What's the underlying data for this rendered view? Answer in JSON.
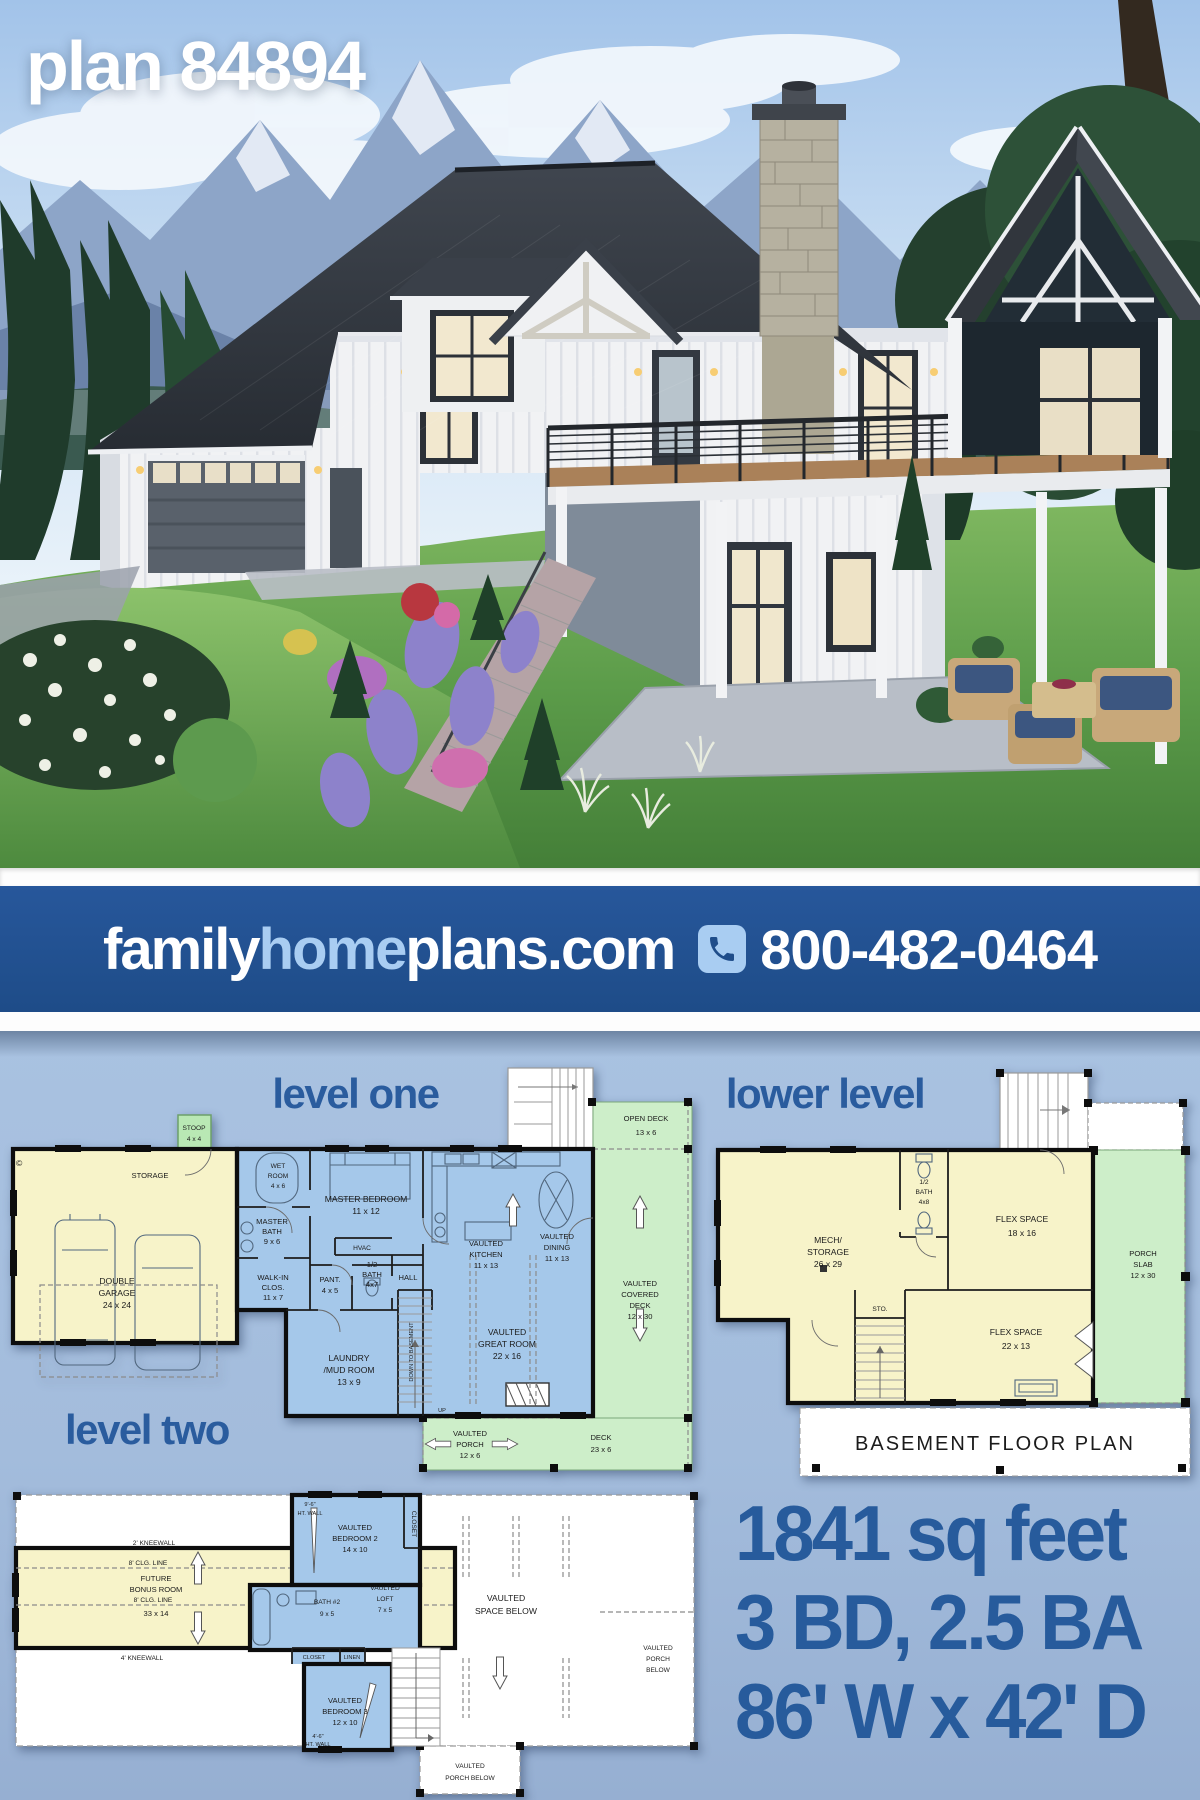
{
  "page": {
    "title_overlay": "plan 84894"
  },
  "banner": {
    "brand_family": "family",
    "brand_home": "home",
    "brand_plans": "plans.com",
    "phone": "800-482-0464"
  },
  "titles": {
    "level_one": "level one",
    "lower_level": "lower level",
    "level_two": "level two"
  },
  "stats": {
    "area": "1841 sq feet",
    "bed_bath": "3 BD, 2.5 BA",
    "size": "86' W x 42' D"
  },
  "colors": {
    "banner_bg": "#21508e",
    "accent_text": "#275b9c",
    "light_blue": "#a9cdf2",
    "plan_blue": "#a5c8ea",
    "plan_yellow": "#f7f3c9",
    "plan_green": "#cdeec9"
  },
  "level_one": {
    "stoop": [
      "STOOP",
      "4 x 4"
    ],
    "storage": "STORAGE",
    "garage": [
      "DOUBLE",
      "GARAGE",
      "24 x 24"
    ],
    "copyright": "©",
    "wet_room": [
      "WET",
      "ROOM",
      "4 x 6"
    ],
    "master_bath": [
      "MASTER",
      "BATH",
      "9 x 6"
    ],
    "master_bedroom": [
      "MASTER BEDROOM",
      "11 x 12"
    ],
    "walk_in": [
      "WALK-IN",
      "CLOS.",
      "11 x 7"
    ],
    "pantry": [
      "PANT.",
      "4 x 5"
    ],
    "half_bath": [
      "1/2",
      "BATH",
      "4x7"
    ],
    "hall": "HALL",
    "hvac": "HVAC",
    "laundry": [
      "LAUNDRY",
      "/MUD ROOM",
      "13 x 9"
    ],
    "kitchen": [
      "VAULTED",
      "KITCHEN",
      "11 x 13"
    ],
    "dining": [
      "VAULTED",
      "DINING",
      "11 x 13"
    ],
    "great_room": [
      "VAULTED",
      "GREAT ROOM",
      "22 x 16"
    ],
    "open_deck": [
      "OPEN DECK",
      "13 x 6"
    ],
    "covered_deck": [
      "VAULTED",
      "COVERED",
      "DECK",
      "12 x 30"
    ],
    "porch": [
      "VAULTED",
      "PORCH",
      "12 x 6"
    ],
    "deck": [
      "DECK",
      "23 x 6"
    ],
    "down_to_basement": "DOWN TO BASEMENT",
    "up": "UP"
  },
  "lower_level": {
    "half_bath": [
      "1/2",
      "BATH",
      "4x8"
    ],
    "flex1": [
      "FLEX SPACE",
      "18 x 16"
    ],
    "mech": [
      "MECH/",
      "STORAGE",
      "26 x 29"
    ],
    "sto": "STO.",
    "flex2": [
      "FLEX SPACE",
      "22 x 13"
    ],
    "porch_slab": [
      "PORCH",
      "SLAB",
      "12 x 30"
    ],
    "caption": "BASEMENT FLOOR PLAN"
  },
  "level_two": {
    "bonus": [
      "FUTURE",
      "BONUS ROOM",
      "33 x 14"
    ],
    "kneewall_top": "2' KNEEWALL",
    "clg_line1": "8' CLG. LINE",
    "clg_line2": "8' CLG. LINE",
    "kneewall_bottom": "4' KNEEWALL",
    "ht_wall_top": [
      "9'-6\"",
      "HT. WALL"
    ],
    "bedroom2": [
      "VAULTED",
      "BEDROOM 2",
      "14 x 10"
    ],
    "closet_vert": "CLOSET",
    "bath2": [
      "BATH #2",
      "9 x 5"
    ],
    "loft": [
      "VAULTED",
      "LOFT",
      "7 x 5"
    ],
    "closet": "CLOSET",
    "linen": "LINEN",
    "bedroom3": [
      "VAULTED",
      "BEDROOM 3",
      "12 x 10"
    ],
    "ht_wall_bottom": [
      "4'-6\"",
      "HT. WALL"
    ],
    "vaulted_space": [
      "VAULTED",
      "SPACE BELOW"
    ],
    "porch_below_right": [
      "VAULTED",
      "PORCH",
      "BELOW"
    ],
    "porch_below_bottom": [
      "VAULTED",
      "PORCH BELOW"
    ]
  }
}
